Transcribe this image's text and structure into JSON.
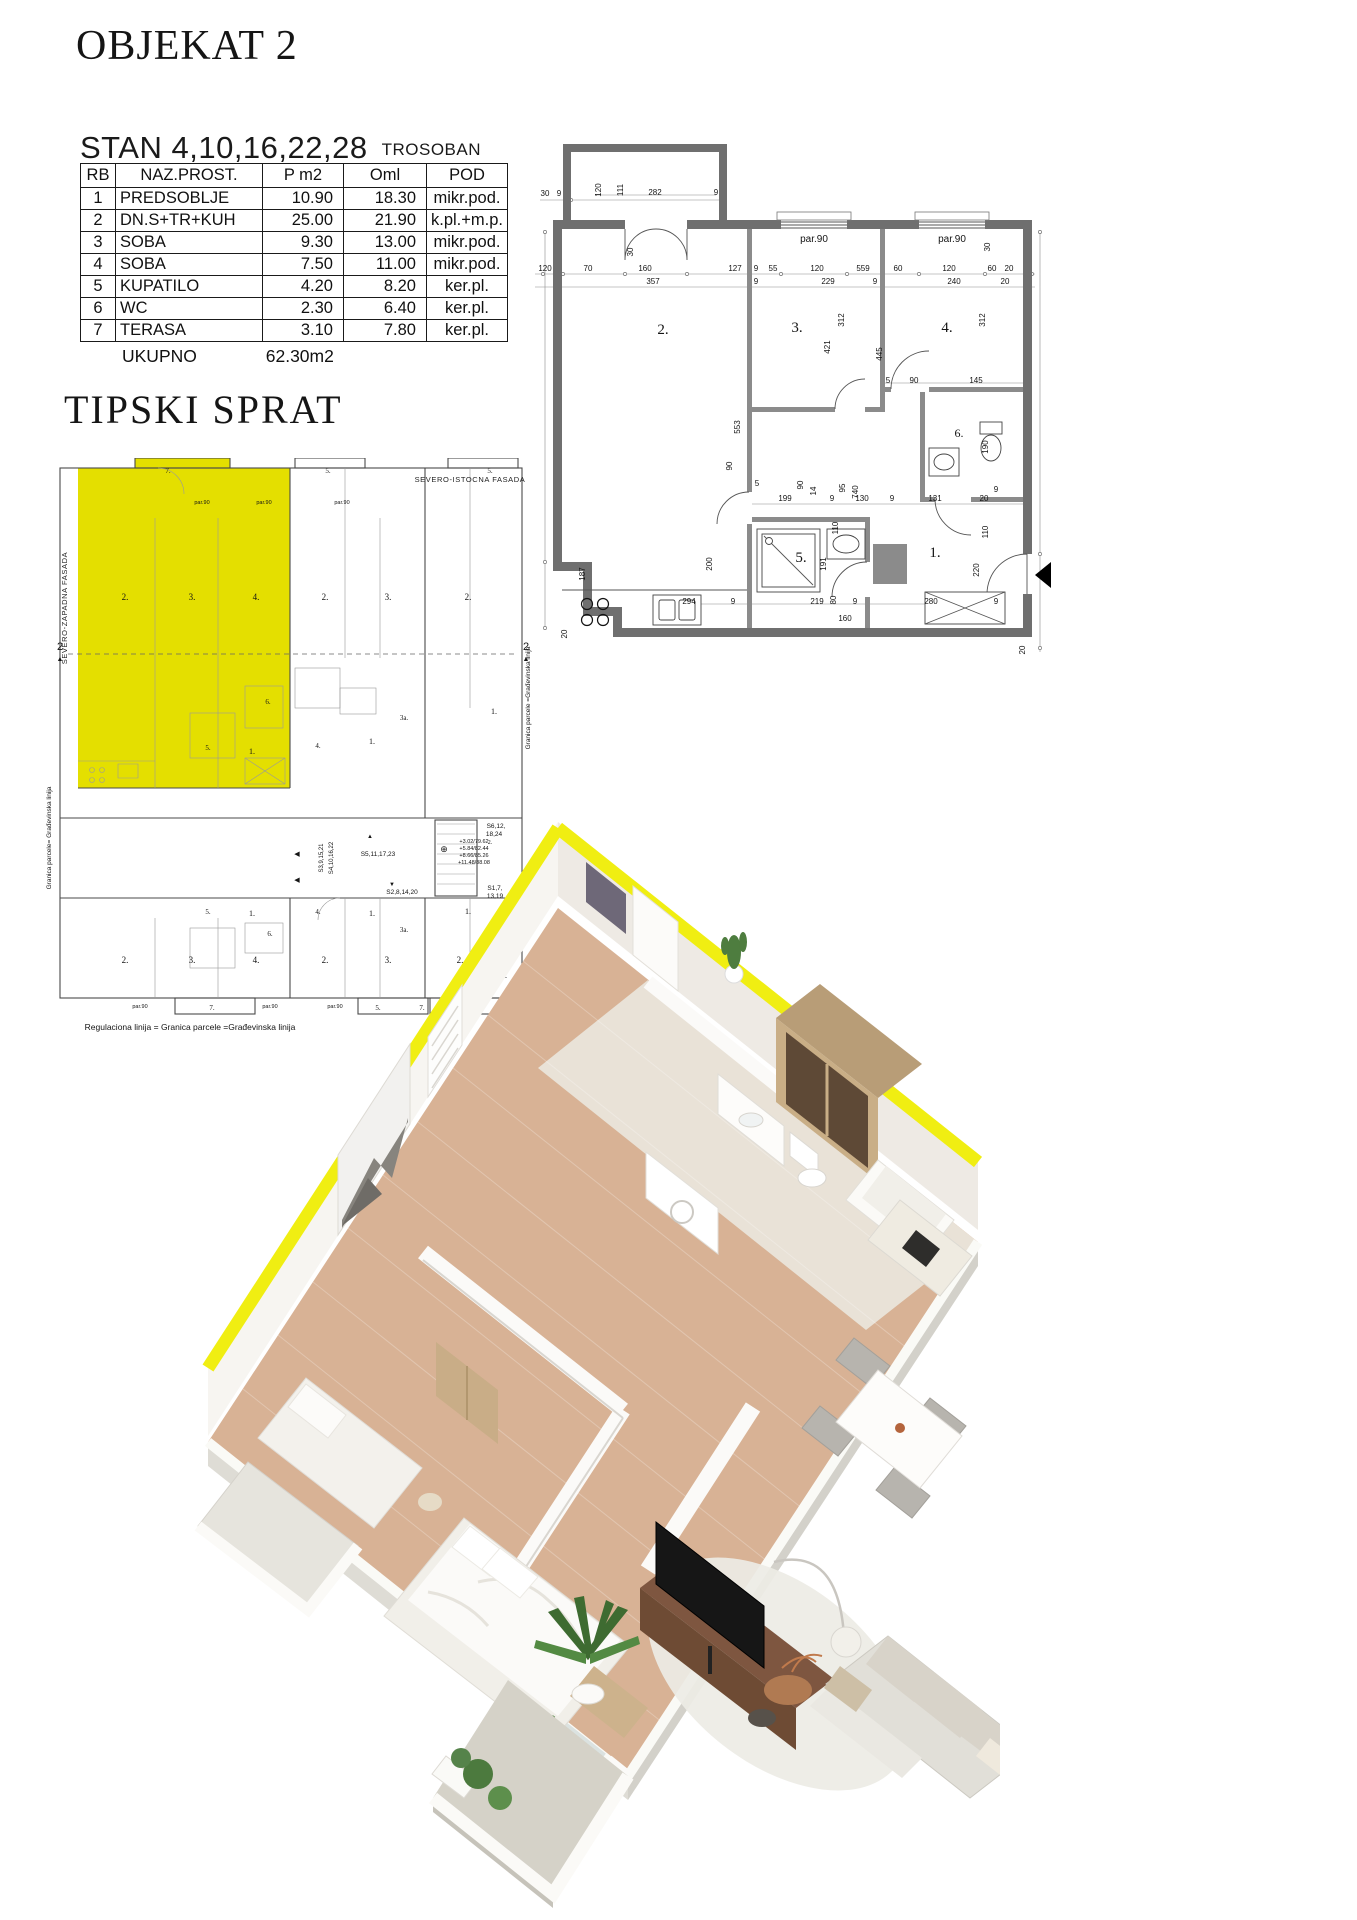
{
  "page": {
    "title": "OBJEKAT 2",
    "stan_title": "STAN 4,10,16,22,28",
    "stan_type": "TROSOBAN",
    "total_label": "UKUPNO",
    "total_value": "62.30m2",
    "section2_title": "TIPSKI SPRAT"
  },
  "table": {
    "headers": [
      "RB",
      "NAZ.PROST.",
      "P m2",
      "Oml",
      "POD"
    ],
    "rows": [
      [
        "1",
        "PREDSOBLJE",
        "10.90",
        "18.30",
        "mikr.pod."
      ],
      [
        "2",
        "DN.S+TR+KUH",
        "25.00",
        "21.90",
        "k.pl.+m.p."
      ],
      [
        "3",
        "SOBA",
        "9.30",
        "13.00",
        "mikr.pod."
      ],
      [
        "4",
        "SOBA",
        "7.50",
        "11.00",
        "mikr.pod."
      ],
      [
        "5",
        "KUPATILO",
        "4.20",
        "8.20",
        "ker.pl."
      ],
      [
        "6",
        "WC",
        "2.30",
        "6.40",
        "ker.pl."
      ],
      [
        "7",
        "TERASA",
        "3.10",
        "7.80",
        "ker.pl."
      ]
    ]
  },
  "colors": {
    "apartment_highlight": "#e4df00",
    "render_wall_top_yellow": "#f0ee12",
    "plan_wall_gray": "#6f6f6f",
    "interior_wall_gray": "#8b8b8b",
    "wood_floor": "#d8b295",
    "marble_floor": "#eae6dc",
    "walnut_furniture": "#6e4b34"
  },
  "large_plan": {
    "room_labels": [
      {
        "t": "2.",
        "x": 128,
        "y": 242,
        "fs": 15,
        "cls": "room"
      },
      {
        "t": "3.",
        "x": 262,
        "y": 240,
        "fs": 15,
        "cls": "room"
      },
      {
        "t": "4.",
        "x": 412,
        "y": 240,
        "fs": 15,
        "cls": "room"
      },
      {
        "t": "6.",
        "x": 424,
        "y": 345,
        "fs": 12,
        "cls": "room"
      },
      {
        "t": "5.",
        "x": 266,
        "y": 470,
        "fs": 15,
        "cls": "room"
      },
      {
        "t": "1.",
        "x": 400,
        "y": 465,
        "fs": 15,
        "cls": "room"
      }
    ],
    "window_labels": [
      {
        "t": "par.90",
        "x": 279,
        "y": 150,
        "fs": 10
      },
      {
        "t": "par.90",
        "x": 417,
        "y": 150,
        "fs": 10
      }
    ],
    "dim_labels": [
      {
        "t": "30",
        "x": 10,
        "y": 104
      },
      {
        "t": "9",
        "x": 24,
        "y": 104
      },
      {
        "t": "120",
        "x": 66,
        "y": 98,
        "r": -90
      },
      {
        "t": "111",
        "x": 88,
        "y": 98,
        "r": -90
      },
      {
        "t": "282",
        "x": 120,
        "y": 103
      },
      {
        "t": "9",
        "x": 181,
        "y": 103
      },
      {
        "t": "30",
        "x": 98,
        "y": 160,
        "r": -90
      },
      {
        "t": "120",
        "x": 10,
        "y": 179
      },
      {
        "t": "70",
        "x": 53,
        "y": 179
      },
      {
        "t": "160",
        "x": 110,
        "y": 179
      },
      {
        "t": "127",
        "x": 200,
        "y": 179
      },
      {
        "t": "9",
        "x": 221,
        "y": 179
      },
      {
        "t": "55",
        "x": 238,
        "y": 179
      },
      {
        "t": "120",
        "x": 282,
        "y": 179
      },
      {
        "t": "559",
        "x": 328,
        "y": 179
      },
      {
        "t": "60",
        "x": 363,
        "y": 179
      },
      {
        "t": "120",
        "x": 414,
        "y": 179
      },
      {
        "t": "60",
        "x": 457,
        "y": 179
      },
      {
        "t": "20",
        "x": 474,
        "y": 179
      },
      {
        "t": "357",
        "x": 118,
        "y": 192
      },
      {
        "t": "9",
        "x": 221,
        "y": 192
      },
      {
        "t": "229",
        "x": 293,
        "y": 192
      },
      {
        "t": "9",
        "x": 340,
        "y": 192
      },
      {
        "t": "240",
        "x": 419,
        "y": 192
      },
      {
        "t": "20",
        "x": 470,
        "y": 192
      },
      {
        "t": "30",
        "x": 455,
        "y": 155,
        "r": -90
      },
      {
        "t": "312",
        "x": 309,
        "y": 228,
        "r": -90
      },
      {
        "t": "421",
        "x": 295,
        "y": 255,
        "r": -90
      },
      {
        "t": "312",
        "x": 450,
        "y": 228,
        "r": -90
      },
      {
        "t": "445",
        "x": 347,
        "y": 262,
        "r": -90
      },
      {
        "t": "740",
        "x": 323,
        "y": 400,
        "r": -90
      },
      {
        "t": "553",
        "x": 205,
        "y": 335,
        "r": -90
      },
      {
        "t": "199",
        "x": 250,
        "y": 409
      },
      {
        "t": "90",
        "x": 268,
        "y": 393,
        "r": -90
      },
      {
        "t": "14",
        "x": 281,
        "y": 399,
        "r": -90
      },
      {
        "t": "9",
        "x": 297,
        "y": 409
      },
      {
        "t": "130",
        "x": 327,
        "y": 409
      },
      {
        "t": "9",
        "x": 357,
        "y": 409
      },
      {
        "t": "131",
        "x": 400,
        "y": 409
      },
      {
        "t": "20",
        "x": 449,
        "y": 409
      },
      {
        "t": "5",
        "x": 353,
        "y": 291
      },
      {
        "t": "90",
        "x": 379,
        "y": 291
      },
      {
        "t": "145",
        "x": 441,
        "y": 291
      },
      {
        "t": "190",
        "x": 453,
        "y": 355,
        "r": -90
      },
      {
        "t": "9",
        "x": 461,
        "y": 400
      },
      {
        "t": "110",
        "x": 453,
        "y": 440,
        "r": -90
      },
      {
        "t": "220",
        "x": 444,
        "y": 478,
        "r": -90
      },
      {
        "t": "20",
        "x": 490,
        "y": 558,
        "r": -90
      },
      {
        "t": "95",
        "x": 310,
        "y": 396,
        "r": -90
      },
      {
        "t": "110",
        "x": 303,
        "y": 436,
        "r": -90
      },
      {
        "t": "5",
        "x": 222,
        "y": 394
      },
      {
        "t": "90",
        "x": 197,
        "y": 374,
        "r": -90
      },
      {
        "t": "191",
        "x": 291,
        "y": 472,
        "r": -90
      },
      {
        "t": "80",
        "x": 301,
        "y": 508,
        "r": -90
      },
      {
        "t": "187",
        "x": 50,
        "y": 482,
        "r": -90
      },
      {
        "t": "200",
        "x": 177,
        "y": 472,
        "r": -90
      },
      {
        "t": "20",
        "x": 32,
        "y": 542,
        "r": -90
      },
      {
        "t": "294",
        "x": 154,
        "y": 512
      },
      {
        "t": "9",
        "x": 198,
        "y": 512
      },
      {
        "t": "219",
        "x": 282,
        "y": 512
      },
      {
        "t": "9",
        "x": 320,
        "y": 512
      },
      {
        "t": "280",
        "x": 396,
        "y": 512
      },
      {
        "t": "160",
        "x": 310,
        "y": 529
      },
      {
        "t": "9",
        "x": 461,
        "y": 512
      }
    ]
  },
  "small_plan": {
    "labels": [
      {
        "t": "7.",
        "x": 128,
        "y": 15,
        "fs": 7,
        "cls": "room"
      },
      {
        "t": "par.90",
        "x": 162,
        "y": 46,
        "fs": 5.5
      },
      {
        "t": "par.90",
        "x": 224,
        "y": 46,
        "fs": 5.5
      },
      {
        "t": "2.",
        "x": 85,
        "y": 142,
        "fs": 9,
        "cls": "room"
      },
      {
        "t": "3.",
        "x": 152,
        "y": 142,
        "fs": 9,
        "cls": "room"
      },
      {
        "t": "4.",
        "x": 216,
        "y": 142,
        "fs": 9,
        "cls": "room"
      },
      {
        "t": "6.",
        "x": 228,
        "y": 246,
        "fs": 7,
        "cls": "room"
      },
      {
        "t": "5.",
        "x": 168,
        "y": 292,
        "fs": 7,
        "cls": "room"
      },
      {
        "t": "1.",
        "x": 212,
        "y": 296,
        "fs": 8,
        "cls": "room"
      },
      {
        "t": "5.",
        "x": 288,
        "y": 15,
        "fs": 7,
        "cls": "room"
      },
      {
        "t": "par.90",
        "x": 302,
        "y": 46,
        "fs": 5.5
      },
      {
        "t": "2.",
        "x": 285,
        "y": 142,
        "fs": 9,
        "cls": "room"
      },
      {
        "t": "3.",
        "x": 348,
        "y": 142,
        "fs": 9,
        "cls": "room"
      },
      {
        "t": "4.",
        "x": 278,
        "y": 290,
        "fs": 7,
        "cls": "room"
      },
      {
        "t": "1.",
        "x": 332,
        "y": 286,
        "fs": 8,
        "cls": "room"
      },
      {
        "t": "3a.",
        "x": 364,
        "y": 262,
        "fs": 7,
        "cls": "room"
      },
      {
        "t": "5.",
        "x": 450,
        "y": 15,
        "fs": 7,
        "cls": "room"
      },
      {
        "t": "2.",
        "x": 428,
        "y": 142,
        "fs": 9,
        "cls": "room"
      },
      {
        "t": "1.",
        "x": 454,
        "y": 256,
        "fs": 8,
        "cls": "room"
      },
      {
        "t": "SEVERO-ISTOCNA  FASADA",
        "x": 430,
        "y": 24,
        "fs": 7.5,
        "cls": "cap"
      },
      {
        "t": "SEVERO-ZAPADNA FASADA",
        "x": 27,
        "y": 150,
        "fs": 7.5,
        "r": -90,
        "cls": "cap"
      },
      {
        "t": "Granica parcele= Građevinska linija",
        "x": 11,
        "y": 380,
        "fs": 6.5,
        "r": -90
      },
      {
        "t": "Granica parcele =Građevinska linija",
        "x": 490,
        "y": 240,
        "fs": 6.5,
        "r": -90
      },
      {
        "t": "2",
        "x": 20,
        "y": 192,
        "fs": 11
      },
      {
        "t": "▲",
        "x": 20,
        "y": 203,
        "fs": 7
      },
      {
        "t": "2",
        "x": 486,
        "y": 192,
        "fs": 11
      },
      {
        "t": "▲",
        "x": 486,
        "y": 203,
        "fs": 7
      },
      {
        "t": "◀",
        "x": 257,
        "y": 398,
        "fs": 7
      },
      {
        "t": "◀",
        "x": 257,
        "y": 424,
        "fs": 7
      },
      {
        "t": "S3,9,15,21",
        "x": 283,
        "y": 400,
        "fs": 6,
        "r": -90
      },
      {
        "t": "S4,10,16,22",
        "x": 293,
        "y": 400,
        "fs": 6,
        "r": -90
      },
      {
        "t": "S5,11,17,23",
        "x": 338,
        "y": 398,
        "fs": 6.5
      },
      {
        "t": "▲",
        "x": 330,
        "y": 380,
        "fs": 6
      },
      {
        "t": "⊕",
        "x": 404,
        "y": 394,
        "fs": 9
      },
      {
        "t": "+3.02/79.62",
        "x": 434,
        "y": 385,
        "fs": 5.5
      },
      {
        "t": "+5.84/82.44",
        "x": 434,
        "y": 392,
        "fs": 5.5
      },
      {
        "t": "+8.66/85.26",
        "x": 434,
        "y": 399,
        "fs": 5.5
      },
      {
        "t": "+11.48/88.08",
        "x": 434,
        "y": 406,
        "fs": 5.5
      },
      {
        "t": "S6,12,",
        "x": 456,
        "y": 370,
        "fs": 6.5
      },
      {
        "t": "18,24",
        "x": 454,
        "y": 378,
        "fs": 6.5
      },
      {
        "t": "2.",
        "x": 450,
        "y": 386,
        "fs": 6,
        "cls": "room"
      },
      {
        "t": "▼",
        "x": 352,
        "y": 428,
        "fs": 6
      },
      {
        "t": "S2,8,14,20",
        "x": 362,
        "y": 436,
        "fs": 6.5
      },
      {
        "t": "S1,7,",
        "x": 455,
        "y": 432,
        "fs": 6.5
      },
      {
        "t": "13,19",
        "x": 455,
        "y": 440,
        "fs": 6.5
      },
      {
        "t": "5.",
        "x": 168,
        "y": 456,
        "fs": 7,
        "cls": "room"
      },
      {
        "t": "1.",
        "x": 212,
        "y": 458,
        "fs": 8,
        "cls": "room"
      },
      {
        "t": "6.",
        "x": 230,
        "y": 478,
        "fs": 7,
        "cls": "room"
      },
      {
        "t": "4.",
        "x": 278,
        "y": 456,
        "fs": 7,
        "cls": "room"
      },
      {
        "t": "1.",
        "x": 332,
        "y": 458,
        "fs": 8,
        "cls": "room"
      },
      {
        "t": "3a.",
        "x": 364,
        "y": 474,
        "fs": 7,
        "cls": "room"
      },
      {
        "t": "1.",
        "x": 428,
        "y": 456,
        "fs": 8,
        "cls": "room"
      },
      {
        "t": "6.",
        "x": 452,
        "y": 472,
        "fs": 7,
        "cls": "room"
      },
      {
        "t": "2.",
        "x": 85,
        "y": 505,
        "fs": 9,
        "cls": "room"
      },
      {
        "t": "3.",
        "x": 152,
        "y": 505,
        "fs": 9,
        "cls": "room"
      },
      {
        "t": "4.",
        "x": 216,
        "y": 505,
        "fs": 9,
        "cls": "room"
      },
      {
        "t": "2.",
        "x": 285,
        "y": 505,
        "fs": 9,
        "cls": "room"
      },
      {
        "t": "3.",
        "x": 348,
        "y": 505,
        "fs": 9,
        "cls": "room"
      },
      {
        "t": "2.",
        "x": 420,
        "y": 505,
        "fs": 9,
        "cls": "room"
      },
      {
        "t": "3.",
        "x": 464,
        "y": 520,
        "fs": 8,
        "cls": "room"
      },
      {
        "t": "par.90",
        "x": 100,
        "y": 550,
        "fs": 5.5
      },
      {
        "t": "par.90",
        "x": 230,
        "y": 550,
        "fs": 5.5
      },
      {
        "t": "par.90",
        "x": 295,
        "y": 550,
        "fs": 5.5
      },
      {
        "t": "par.90",
        "x": 428,
        "y": 550,
        "fs": 5.5
      },
      {
        "t": "7.",
        "x": 172,
        "y": 552,
        "fs": 7,
        "cls": "room"
      },
      {
        "t": "5.",
        "x": 338,
        "y": 552,
        "fs": 7,
        "cls": "room"
      },
      {
        "t": "7.",
        "x": 382,
        "y": 552,
        "fs": 7,
        "cls": "room"
      },
      {
        "t": "Regulaciona linija = Granica parcele =Građevinska linija",
        "x": 150,
        "y": 572,
        "fs": 8.5
      }
    ]
  }
}
